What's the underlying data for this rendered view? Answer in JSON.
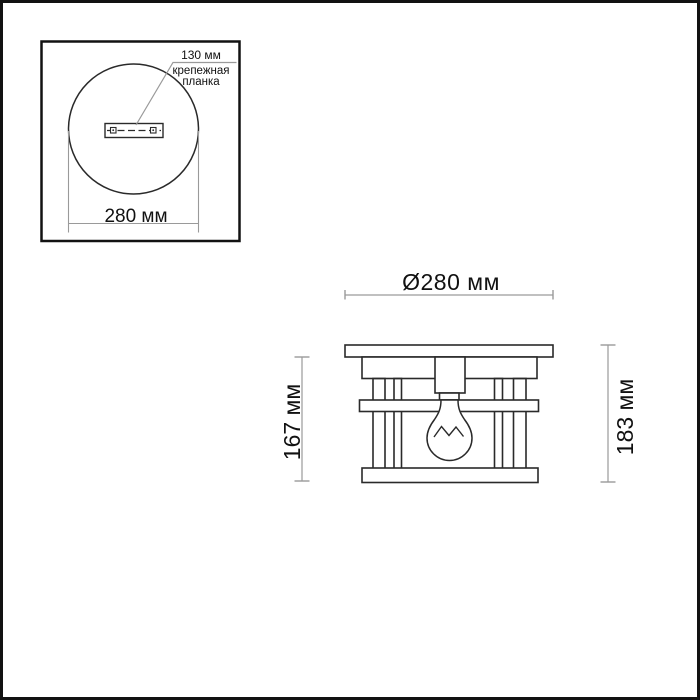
{
  "inset": {
    "mount_size_label": "130 мм",
    "mount_name_line1": "крепежная",
    "mount_name_line2": "планка",
    "diameter_label": "280 мм"
  },
  "front_view": {
    "diameter_label": "Ø280 мм",
    "body_height_label": "167 мм",
    "overall_height_label": "183 мм"
  },
  "colors": {
    "outline": "#2a2a2a",
    "dimension_line": "#9a9a9a",
    "border": "#121212",
    "text": "#111111",
    "background": "#ffffff"
  }
}
